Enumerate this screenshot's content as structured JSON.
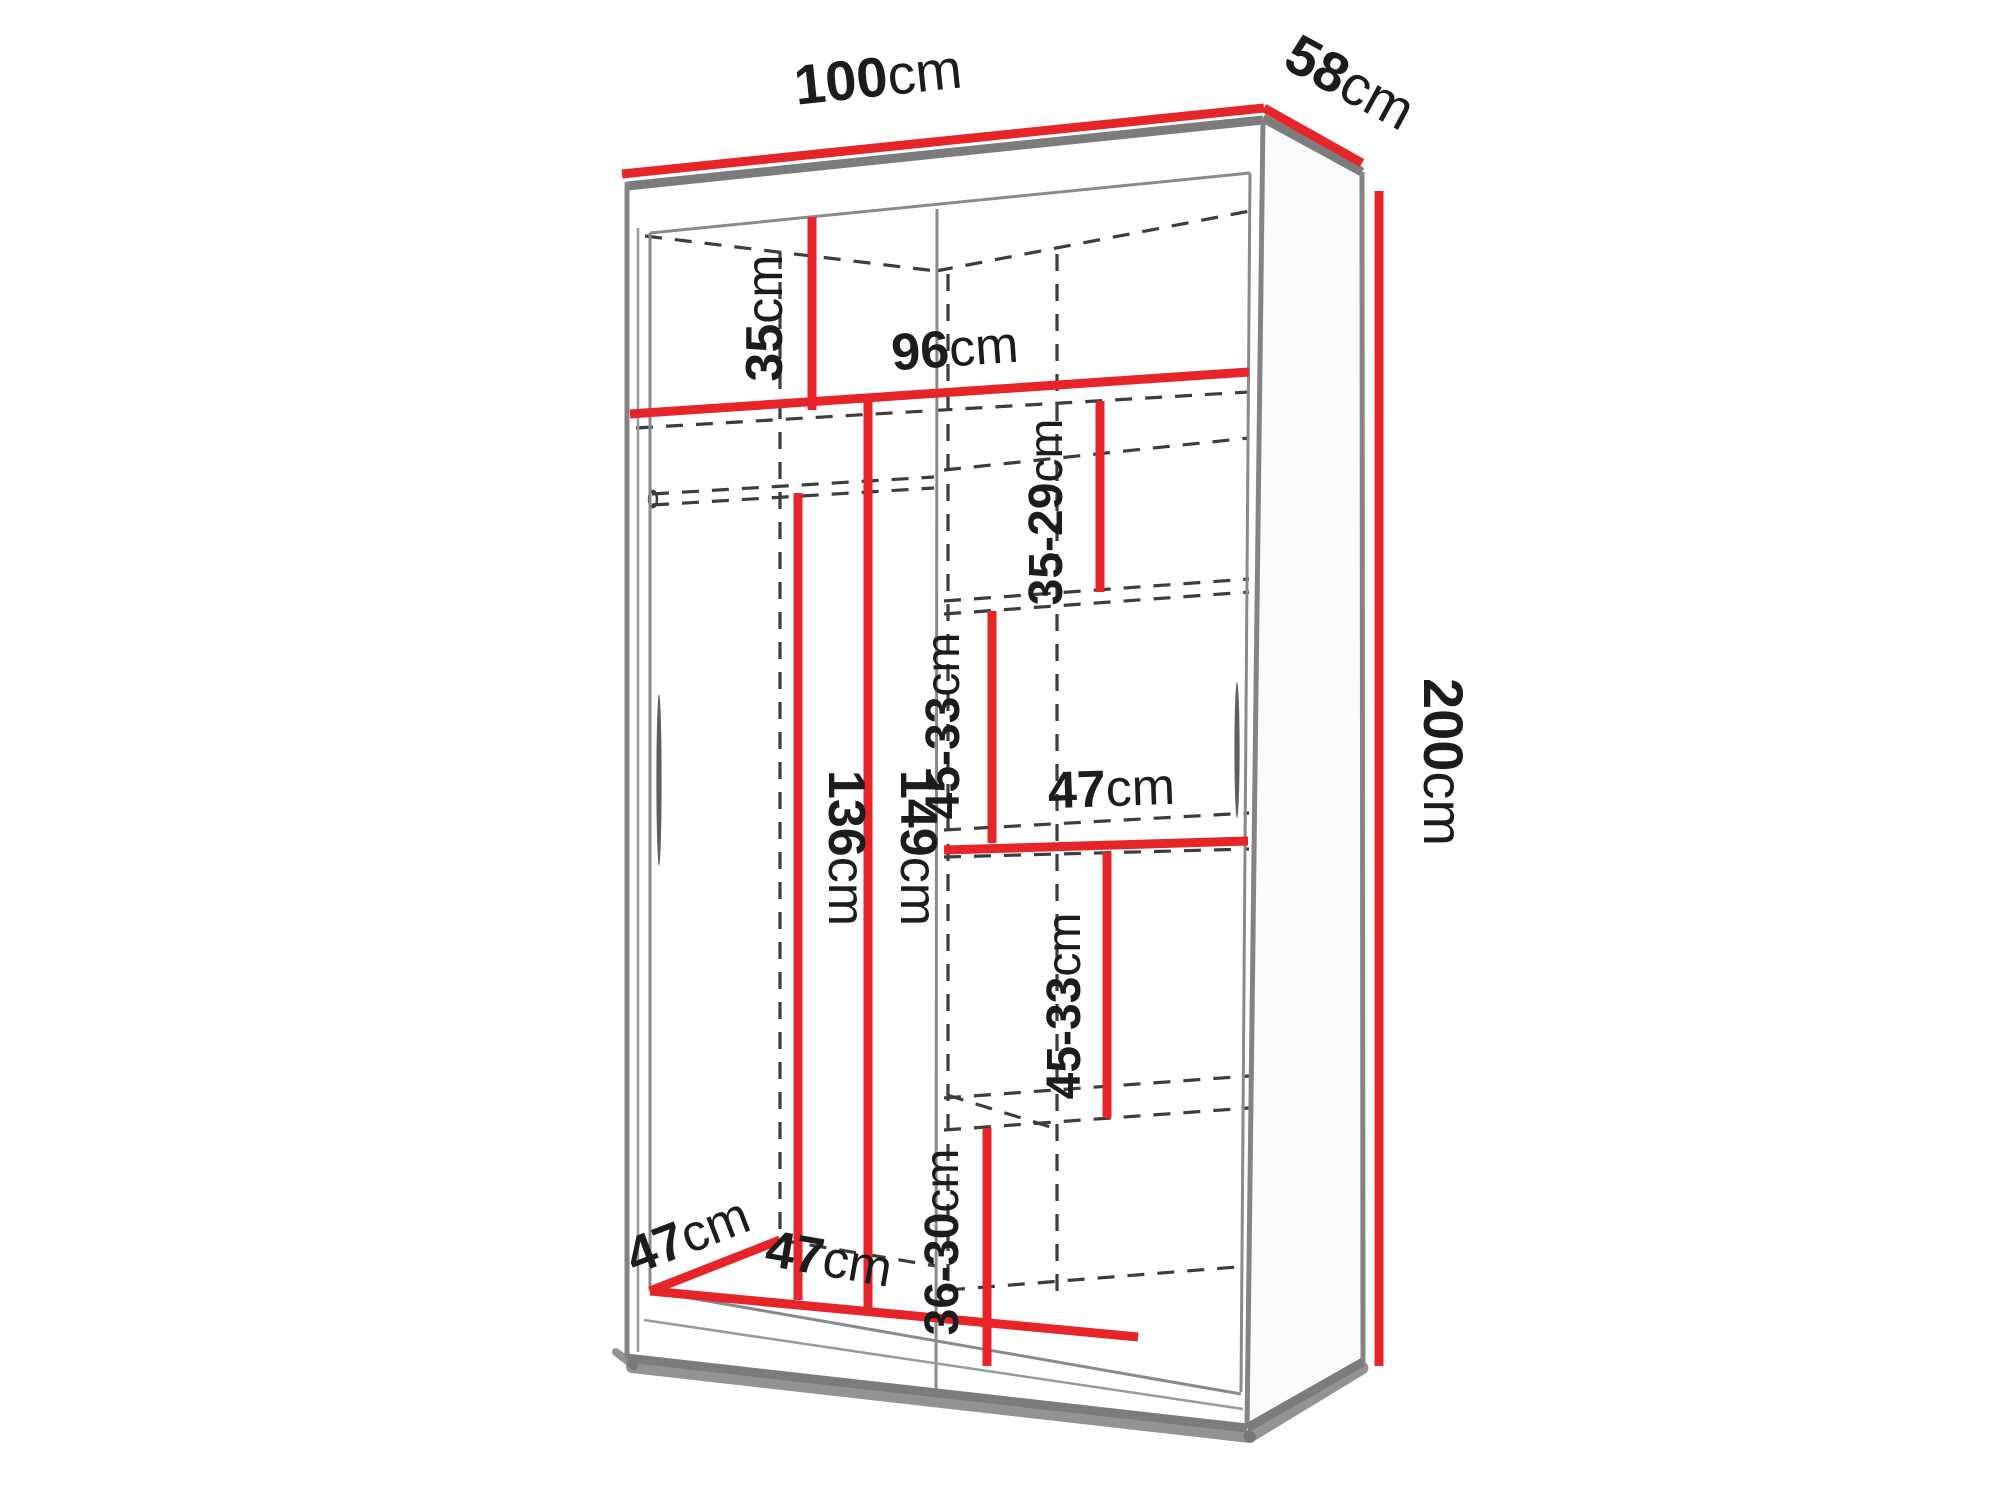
{
  "diagram": {
    "type": "furniture-dimension-diagram",
    "subject": "two-door sliding wardrobe interior dimensions",
    "colors": {
      "dimension_line_red": "#e5252a",
      "edge_gray": "#7c7c7c",
      "dashed_gray": "#3d3d3d",
      "label_text": "#1c1c1c",
      "background": "#ffffff"
    },
    "labels": {
      "width": {
        "value": "100",
        "unit": "cm"
      },
      "depth": {
        "value": "58",
        "unit": "cm"
      },
      "height": {
        "value": "200",
        "unit": "cm"
      },
      "top_compartment_height": {
        "value": "35",
        "unit": "cm"
      },
      "interior_width": {
        "value": "96",
        "unit": "cm"
      },
      "right_gap_top": {
        "value": "35-29",
        "unit": "cm"
      },
      "right_gap_upper": {
        "value": "45-33",
        "unit": "cm"
      },
      "right_shelf_width": {
        "value": "47",
        "unit": "cm"
      },
      "right_gap_lower": {
        "value": "45-33",
        "unit": "cm"
      },
      "right_gap_bottom": {
        "value": "36-30",
        "unit": "cm"
      },
      "hanging_space_height": {
        "value": "136",
        "unit": "cm"
      },
      "left_compartment_height": {
        "value": "149",
        "unit": "cm"
      },
      "interior_depth": {
        "value": "47",
        "unit": "cm"
      },
      "left_compartment_width": {
        "value": "47",
        "unit": "cm"
      }
    }
  }
}
